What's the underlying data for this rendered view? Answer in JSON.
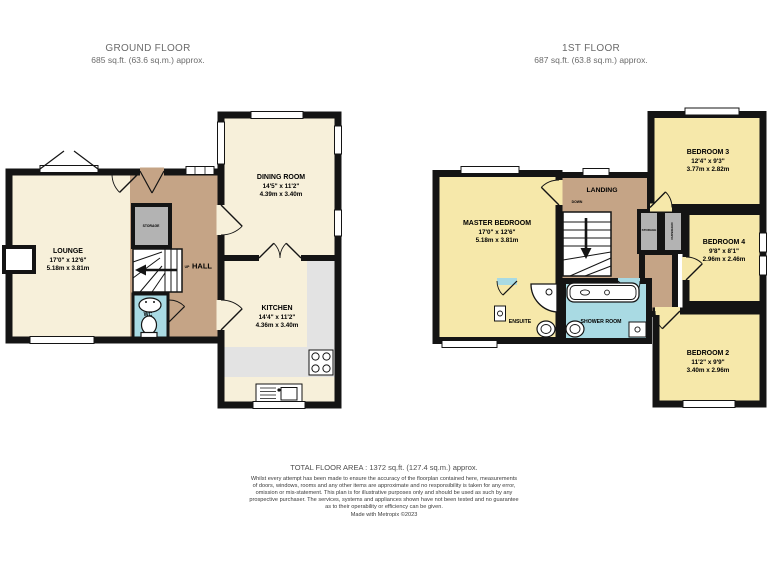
{
  "header": {
    "ground_floor": {
      "title": "GROUND FLOOR",
      "area": "685 sq.ft. (63.6 sq.m.) approx."
    },
    "first_floor": {
      "title": "1ST FLOOR",
      "area": "687 sq.ft. (63.8 sq.m.) approx."
    }
  },
  "ground_floor": {
    "rooms": {
      "lounge": {
        "name": "LOUNGE",
        "imperial": "17'0\" x 12'6\"",
        "metric": "5.18m x 3.81m"
      },
      "dining_room": {
        "name": "DINING ROOM",
        "imperial": "14'5\" x 11'2\"",
        "metric": "4.39m x 3.40m"
      },
      "kitchen": {
        "name": "KITCHEN",
        "imperial": "14'4\" x 11'2\"",
        "metric": "4.36m x 3.40m"
      },
      "hall": {
        "name": "HALL"
      },
      "storage": {
        "name": "STORAGE"
      },
      "wc": {
        "name": "WC"
      },
      "stairs_direction": "UP"
    }
  },
  "first_floor": {
    "rooms": {
      "master_bedroom": {
        "name": "MASTER BEDROOM",
        "imperial": "17'0\" x 12'6\"",
        "metric": "5.18m x 3.81m"
      },
      "bedroom_3": {
        "name": "BEDROOM 3",
        "imperial": "12'4\" x 9'3\"",
        "metric": "3.77m x 2.82m"
      },
      "bedroom_4": {
        "name": "BEDROOM 4",
        "imperial": "9'8\" x 8'1\"",
        "metric": "2.96m x 2.46m"
      },
      "bedroom_2": {
        "name": "BEDROOM 2",
        "imperial": "11'2\" x 9'9\"",
        "metric": "3.40m x 2.96m"
      },
      "landing": {
        "name": "LANDING"
      },
      "storage": {
        "name": "STORAGE"
      },
      "cupboard": {
        "name": "CUPBOARD"
      },
      "ensuite": {
        "name": "ENSUITE"
      },
      "shower_room": {
        "name": "SHOWER ROOM"
      },
      "stairs_direction": "DOWN"
    }
  },
  "footer": {
    "total_area": "TOTAL FLOOR AREA : 1372 sq.ft. (127.4 sq.m.) approx.",
    "disclaimer_lines": [
      "Whilst every attempt has been made to ensure the accuracy of the floorplan contained here, measurements",
      "of doors, windows, rooms and any other items are approximate and no responsibility is taken for any error,",
      "omission or mis-statement. This plan is for illustrative purposes only and should be used as such by any",
      "prospective purchaser. The services, systems and appliances shown have not been tested and no guarantee",
      "as to their operability or efficiency can be given."
    ],
    "credit": "Made with Metropix ©2023"
  },
  "colors": {
    "wall": "#141414",
    "ground_floor_room": "#f7f0da",
    "first_floor_room": "#f6e8aa",
    "hall_landing": "#c5a486",
    "bathroom": "#a9dae3",
    "closet": "#b3b3b3",
    "kitchen_counter": "#e3e3e3"
  }
}
